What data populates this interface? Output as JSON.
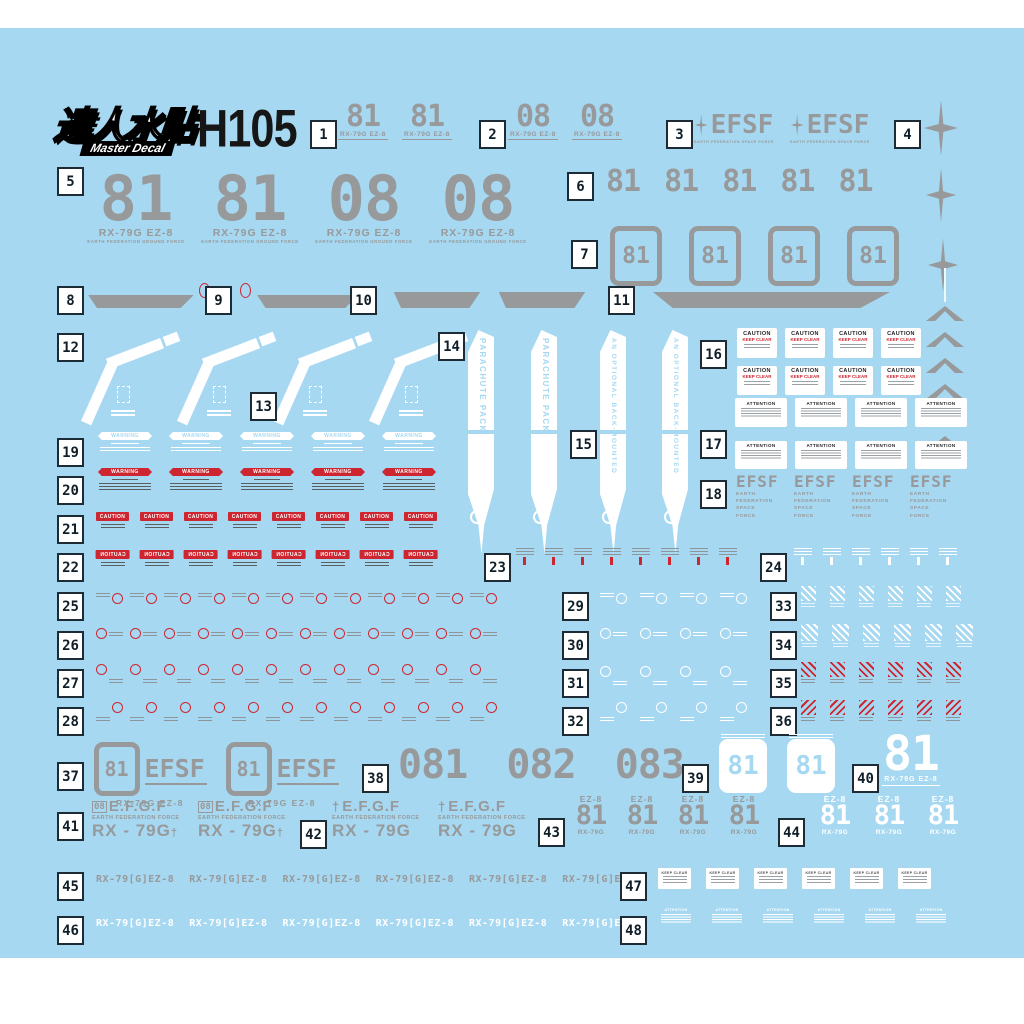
{
  "sheet": {
    "brand_cn": "達人水貼",
    "brand_en": "Master Decal",
    "code": "H105",
    "colors": {
      "bg": "#a7d8f1",
      "gray": "#97999a",
      "red": "#cd2630",
      "navy": "#1c2b36"
    }
  },
  "labels": {
    "n81": "81",
    "n08": "08",
    "n081": "081",
    "n082": "082",
    "n083": "083",
    "rx79g_ez8": "RX-79G EZ-8",
    "ground_force": "EARTH FEDERATION GROUND FORCE",
    "efsf": "EFSF",
    "space_force": "EARTH FEDERATION SPACE FORCE",
    "efsf_lines": [
      "EARTH",
      "FEDERATION",
      "SPACE",
      "FORCE"
    ],
    "parachute": "PARACHUTE PACK",
    "back_mounted": "AN OPTIONAL BACK-MOUNTED",
    "caution": "CAUTION",
    "keep_clear": "KEEP CLEAR",
    "attention": "ATTENTION",
    "warning": "WARNING",
    "efgf": "E.F.G.F",
    "federation_force": "EARTH FEDERATION FORCE",
    "rx79g_sp": "RX - 79G",
    "cross": "†",
    "ez8": "EZ-8",
    "rx79g": "RX-79G",
    "rx79_bracket": "RX-79[G]EZ-8"
  },
  "sections": {
    "s1": {
      "num": "1",
      "count": 2
    },
    "s2": {
      "num": "2",
      "count": 2
    },
    "s3": {
      "num": "3",
      "count": 2
    },
    "s4": {
      "num": "4"
    },
    "s5": {
      "num": "5"
    },
    "s6": {
      "num": "6",
      "count": 5
    },
    "s7": {
      "num": "7",
      "count": 4
    },
    "s8": {
      "num": "8"
    },
    "s9": {
      "num": "9"
    },
    "s10": {
      "num": "10"
    },
    "s11": {
      "num": "11"
    },
    "s12": {
      "num": "12",
      "count": 4
    },
    "s13": {
      "num": "13"
    },
    "s14": {
      "num": "14"
    },
    "s15": {
      "num": "15"
    },
    "s16": {
      "num": "16",
      "count": 8
    },
    "s17": {
      "num": "17",
      "count": 8
    },
    "s18": {
      "num": "18",
      "count": 4
    },
    "s19": {
      "num": "19",
      "count": 5
    },
    "s20": {
      "num": "20",
      "count": 5
    },
    "s21": {
      "num": "21",
      "count": 8
    },
    "s22": {
      "num": "22",
      "count": 8
    },
    "s23": {
      "num": "23",
      "count": 8
    },
    "s24": {
      "num": "24",
      "count": 6
    },
    "s25": {
      "num": "25",
      "count": 12
    },
    "s26": {
      "num": "26",
      "count": 12
    },
    "s27": {
      "num": "27",
      "count": 12
    },
    "s28": {
      "num": "28",
      "count": 12
    },
    "s29": {
      "num": "29",
      "count": 4
    },
    "s30": {
      "num": "30",
      "count": 4
    },
    "s31": {
      "num": "31",
      "count": 4
    },
    "s32": {
      "num": "32",
      "count": 4
    },
    "s33": {
      "num": "33",
      "count": 6
    },
    "s34": {
      "num": "34",
      "count": 6
    },
    "s35": {
      "num": "35",
      "count": 6
    },
    "s36": {
      "num": "36",
      "count": 6
    },
    "s37": {
      "num": "37",
      "count": 2
    },
    "s38": {
      "num": "38"
    },
    "s39": {
      "num": "39",
      "count": 2
    },
    "s40": {
      "num": "40"
    },
    "s41": {
      "num": "41",
      "count": 2
    },
    "s42": {
      "num": "42",
      "count": 2
    },
    "s43": {
      "num": "43",
      "count": 4
    },
    "s44": {
      "num": "44",
      "count": 3
    },
    "s45": {
      "num": "45",
      "count": 6
    },
    "s46": {
      "num": "46",
      "count": 6
    },
    "s47": {
      "num": "47",
      "count": 6
    },
    "s48": {
      "num": "48",
      "count": 6
    }
  }
}
